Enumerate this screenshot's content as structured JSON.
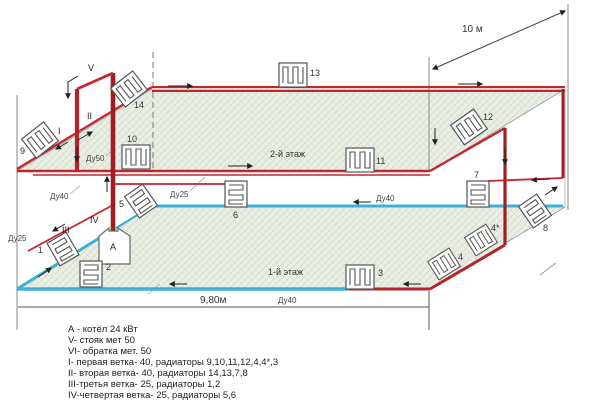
{
  "diagram_title": "two-storey heating system piping scheme",
  "colors": {
    "supply_red": "#c5262c",
    "supply_dark_red": "#a21e23",
    "return_blue": "#3eb0d6",
    "hatch_bg": "#eaefe5",
    "hatch_line": "#c9d3c4",
    "outline_gray": "#8a8a8a",
    "text": "#333333"
  },
  "dims": {
    "depth": "10 м",
    "width": "9,80м"
  },
  "floors": {
    "second": "2-й этаж",
    "first": "1-й этаж"
  },
  "pipes": {
    "du50": "Ду50",
    "du40_left": "Ду40",
    "du40_mid": "Ду40",
    "du40_bottom": "Ду40",
    "du25_left": "Ду25",
    "du25_mid": "Ду25"
  },
  "branches": {
    "v": "V",
    "i": "I",
    "ii": "II",
    "iii": "III",
    "iv": "IV"
  },
  "boiler": {
    "label": "А"
  },
  "radiators": {
    "r1": "1",
    "r2": "2",
    "r3": "3",
    "r4": "4",
    "r4s": "4*",
    "r5": "5",
    "r6": "6",
    "r7": "7",
    "r8": "8",
    "r9": "9",
    "r10": "10",
    "r11": "11",
    "r12": "12",
    "r13": "13",
    "r14": "14"
  },
  "legend": {
    "items": [
      "А - котёл 24 кВт",
      "V- стояк мет 50",
      "VI- обратка мет. 50",
      "I- первая ветка- 40, радиаторы 9,10,11,12,4,4*,3",
      "II- вторая ветка- 40, радиаторы 14,13,7,8",
      "III-третья ветка- 25, радиаторы 1,2",
      "IV-четвертая ветка- 25, радиаторы 5,6"
    ]
  }
}
